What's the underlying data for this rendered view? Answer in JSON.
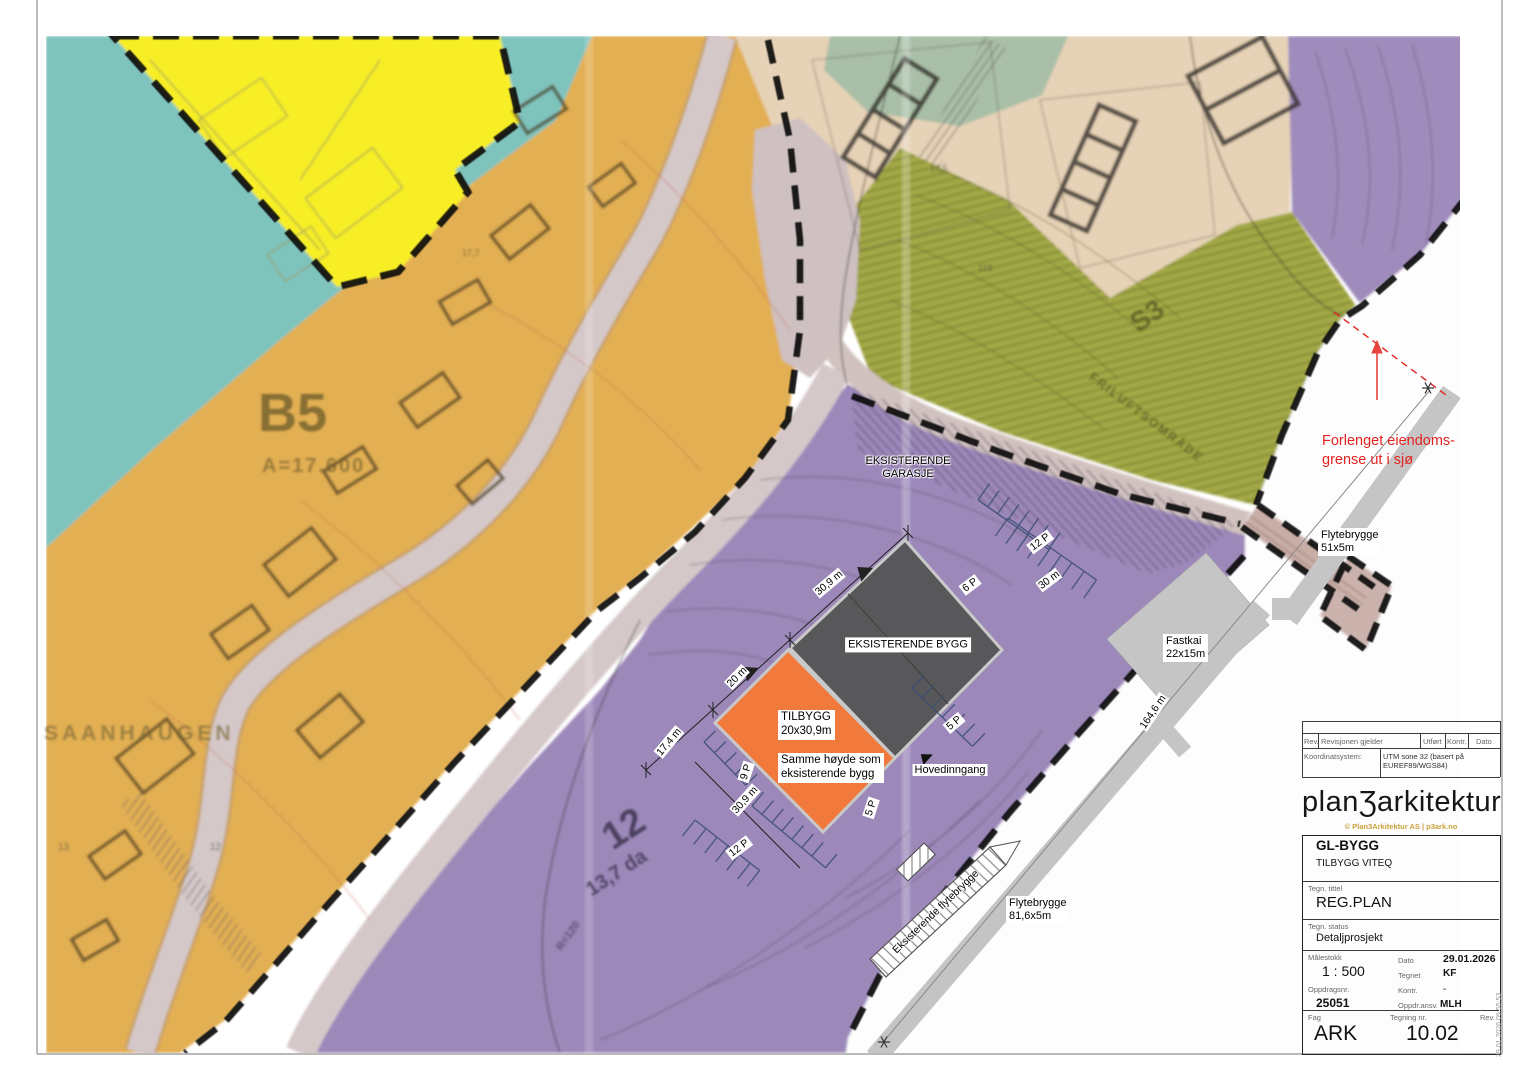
{
  "map": {
    "colors": {
      "water_teal": "#7fc3bd",
      "zone_yellow": "#f7ee28",
      "zone_orange": "#e2af52",
      "zone_purple": "#9d88ba",
      "zone_green": "#a2a845",
      "zone_beige": "#e6d2b6",
      "zone_sage": "#a9bfa7",
      "road": "#d5c8c9",
      "existing_building": "#58585a",
      "new_building": "#f2793c",
      "pier_gray": "#c5c5c5",
      "annotation_red": "#e42320",
      "boundary_black": "#0d0d0d"
    },
    "labels": {
      "garage": "EKSISTERENDE\nGARASJE",
      "existing_building": "EKSISTERENDE BYGG",
      "tilbygg": "TILBYGG\n20x30,9m",
      "tilbygg_note": "Samme høyde som\neksisterende bygg",
      "hovedinngang": "Hovedinngang",
      "p12_upper": "12 P",
      "p6": "6 P",
      "p5_east": "5 P",
      "p5_south": "5 P",
      "p9": "9 P",
      "p12_lower": "12 P",
      "dim_30m": "30 m",
      "dim_30_9_nw": "30,9 m",
      "dim_20m": "20 m",
      "dim_17_4": "17,4 m",
      "dim_30_9_sw": "30,9 m",
      "dim_164_6": "164,6 m",
      "forlenget": "Forlenget eiendoms-\ngrense ut i sjø",
      "flytebrygge_51": "Flytebrygge\n51x5m",
      "fastkai": "Fastkai\n22x15m",
      "flytebrygge_81": "Flytebrygge\n81,6x5m",
      "eksisterende_flytebrygge": "Eksisterende flytebrygge",
      "b5": "B5",
      "b5_area": "A=17.600",
      "saanhaugen": "SAANHAUGEN",
      "s3": "S3",
      "friluft": "FRILUFTSOMRÅDE",
      "area12": "12",
      "area12_size": "13,7 da",
      "r120": "R=120",
      "n14_5": "14,5",
      "n118": "118",
      "n17_7": "17,7",
      "n13": "13",
      "n12": "12"
    }
  },
  "titleblock": {
    "rev_label": "Rev.",
    "revision_label": "Revisjonen gjelder",
    "utfort_label": "Utført",
    "kontr_label": "Kontr.",
    "dato_label": "Dato",
    "koordinatsystem_label": "Koordinatsystem:",
    "koordinatsystem_value": "UTM sone 32 (basert på\nEUREF89/WGS84)",
    "logo": "planƷarkitektur",
    "copyright": "© Plan3Arkitektur AS | p3ark.no",
    "project": "GL-BYGG",
    "subproject": "TILBYGG VITEQ",
    "tegn_tittel_label": "Tegn. tittel",
    "tegn_tittel": "REG.PLAN",
    "tegn_status_label": "Tegn. status",
    "tegn_status": "Detaljprosjekt",
    "malestokk_label": "Målestokk",
    "malestokk": "1 : 500",
    "dato2_label": "Dato",
    "dato_value": "29.01.2026",
    "tegnet_label": "Tegnet",
    "tegnet": "KF",
    "kontr2_label": "Kontr.",
    "kontr2": "-",
    "oppdragsnr_label": "Oppdragsnr.",
    "oppdragsnr": "25051",
    "oppdr_ansv_label": "Oppdr.ansv.",
    "oppdr_ansv": "MLH",
    "fag_label": "Fag",
    "fag": "ARK",
    "tegning_nr_label": "Tegning nr.",
    "tegning_nr": "10.02",
    "rev2_label": "Rev.",
    "timestamp": "29.01.2026 09:55:53"
  }
}
